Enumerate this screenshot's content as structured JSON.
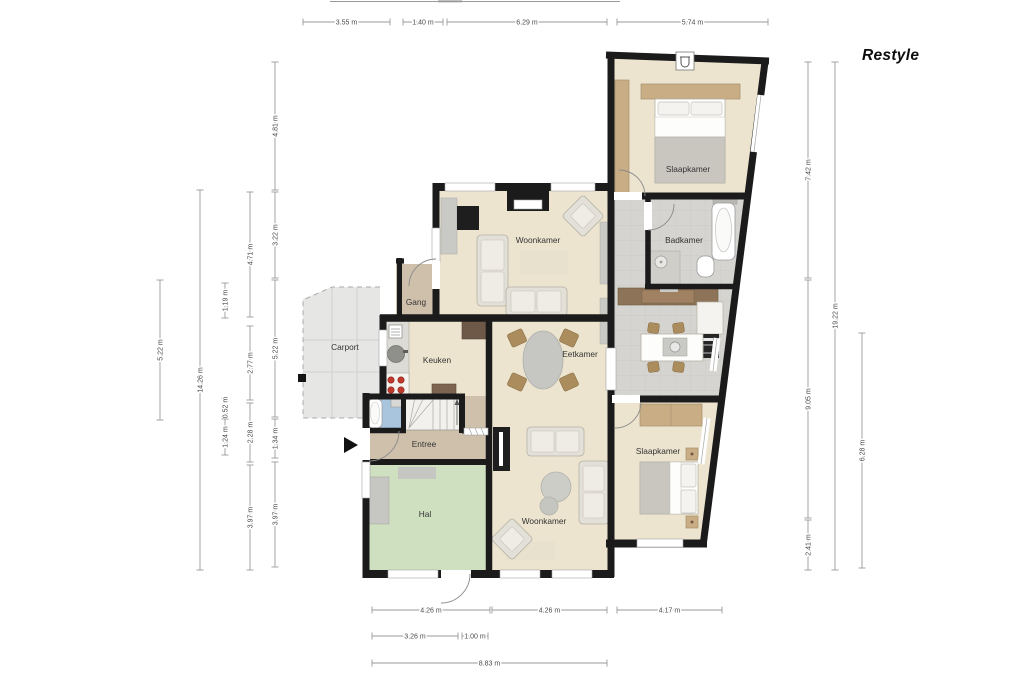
{
  "logo": {
    "text": "Restyle"
  },
  "rooms": {
    "slaapkamer_top": "Slaapkamer",
    "badkamer": "Badkamer",
    "woonkamer_top": "Woonkamer",
    "gang": "Gang",
    "keuken": "Keuken",
    "eetkamer": "Eetkamer",
    "entree": "Entree",
    "hal": "Hal",
    "woonkamer_bottom": "Woonkamer",
    "slaapkamer_bottom": "Slaapkamer",
    "carport": "Carport"
  },
  "dims": {
    "top": [
      {
        "label": "3.55 m"
      },
      {
        "label": "1.40 m"
      },
      {
        "label": "6.29 m"
      },
      {
        "label": "5.74 m"
      }
    ],
    "left": [
      {
        "label": "5.22 m"
      },
      {
        "label": "14.26 m"
      },
      {
        "label": "1.19 m"
      },
      {
        "label": "0.52 m"
      },
      {
        "label": "1.24 m"
      },
      {
        "label": "4.71 m"
      },
      {
        "label": "2.77 m"
      },
      {
        "label": "2.28 m"
      },
      {
        "label": "3.97 m"
      },
      {
        "label": "4.81 m"
      },
      {
        "label": "3.22 m"
      },
      {
        "label": "5.22 m"
      },
      {
        "label": "1.34 m"
      },
      {
        "label": "3.97 m"
      }
    ],
    "right": [
      {
        "label": "7.42 m"
      },
      {
        "label": "9.05 m"
      },
      {
        "label": "2.41 m"
      },
      {
        "label": "19.22 m"
      },
      {
        "label": "6.28 m"
      }
    ],
    "bottom": [
      {
        "label": "4.26 m"
      },
      {
        "label": "4.26 m"
      },
      {
        "label": "4.17 m"
      },
      {
        "label": "3.26 m"
      },
      {
        "label": "1.00 m"
      },
      {
        "label": "8.83 m"
      }
    ]
  },
  "colors": {
    "wall": "#1b1b1b",
    "floor_beige": "#ece4cf",
    "floor_tan": "#cfc0ac",
    "floor_green": "#cfe0c0",
    "floor_tile": "#d5d4d0",
    "floor_carport": "#e6e6e4",
    "wc_blue": "#a9c4dd",
    "wood": "#c8ad85",
    "cabinet_brown": "#8d7358",
    "stove_red": "#c0392b",
    "dim_line": "#9a9a9a",
    "dim_text": "#4a4a4a"
  }
}
